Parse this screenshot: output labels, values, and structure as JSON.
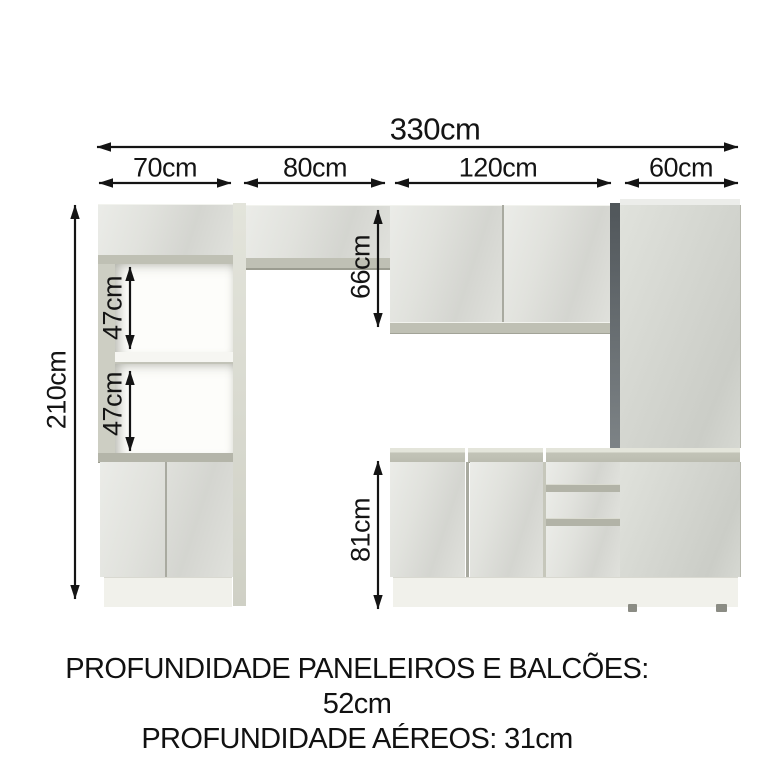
{
  "diagram_labels": {
    "total_width": "330cm",
    "section_1": "70cm",
    "section_2": "80cm",
    "section_3": "120cm",
    "section_4": "60cm",
    "total_height": "210cm",
    "niche_upper": "47cm",
    "niche_lower": "47cm",
    "upper_cabinets_height": "66cm",
    "base_cabinets_height": "81cm"
  },
  "footer": {
    "line1": "PROFUNDIDADE PANELEIROS E BALCÕES: 52cm",
    "line2": "PROFUNDIDADE AÉREOS: 31cm"
  },
  "colors": {
    "arrow_and_text": "#141414",
    "cabinet_face": "#dfe0db",
    "cabinet_edge_band": "#bfc0b4",
    "dark_side_panel": "#5c6266",
    "toe_kick": "#f1f1eb",
    "background": "#ffffff"
  }
}
